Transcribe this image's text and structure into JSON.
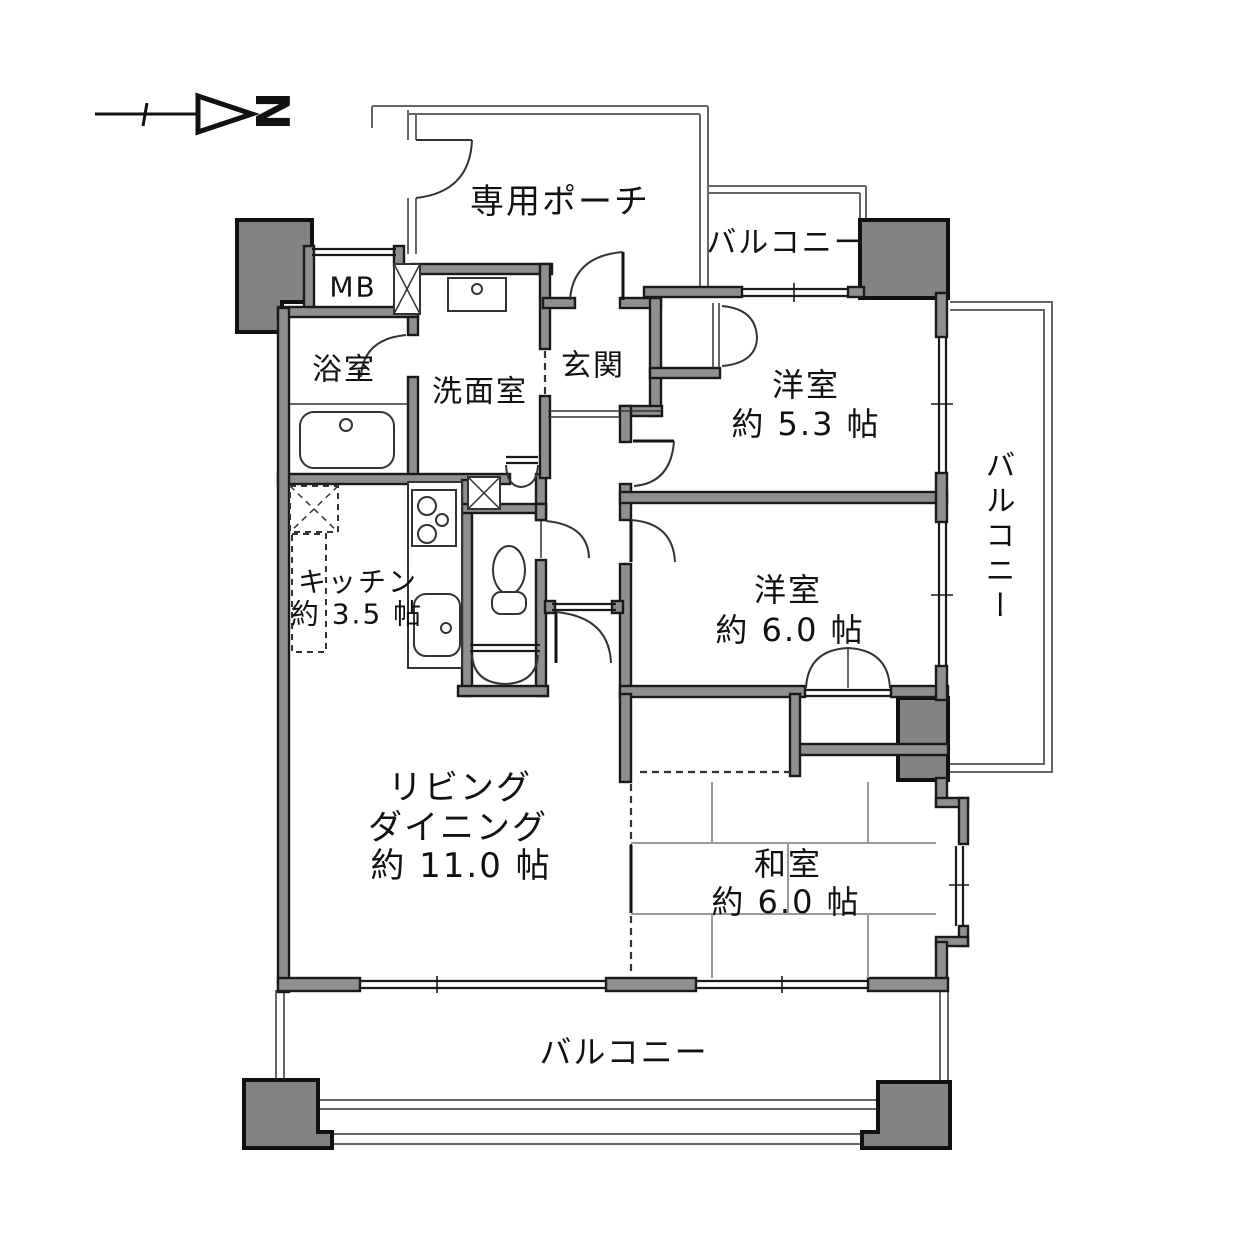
{
  "page": {
    "background": "#ffffff"
  },
  "colors": {
    "wall_fill": "#8f8f8f",
    "wall_stroke": "#1a1a1a",
    "pillar_fill": "#838383",
    "thin_line": "#666666",
    "tatami_line": "#9a9a9a",
    "text": "#111111"
  },
  "compass": {
    "north_label": "N"
  },
  "labels": {
    "porch": "専用ポーチ",
    "balcony_top": "バルコニー",
    "balcony_right": "バルコニー",
    "balcony_bottom": "バルコニー",
    "meter_box": "MB",
    "bathroom": "浴室",
    "washroom": "洗面室",
    "entrance": "玄関",
    "western_room_1": {
      "name": "洋室",
      "size": "約 5.3 帖"
    },
    "western_room_2": {
      "name": "洋室",
      "size": "約 6.0 帖"
    },
    "kitchen": {
      "name": "キッチン",
      "size": "約 3.5 帖"
    },
    "living_dining": {
      "line1": "リビング",
      "line2": "ダイニング",
      "line3": "約 11.0 帖"
    },
    "japanese_room": {
      "name": "和室",
      "size": "約 6.0 帖"
    }
  }
}
